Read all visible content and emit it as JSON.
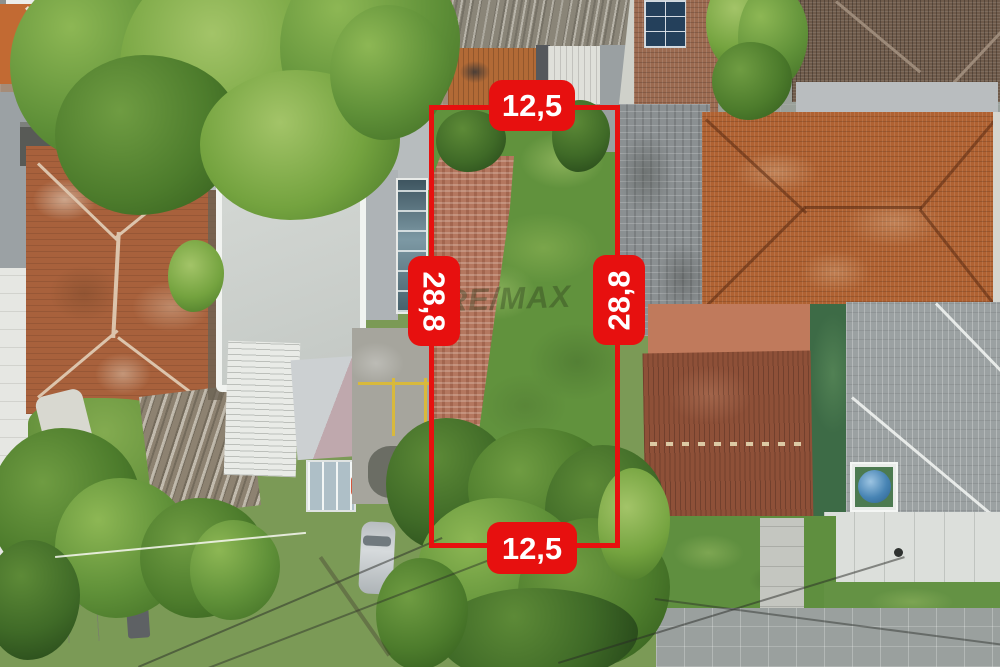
{
  "annotation": {
    "accent_color": "#e7100f",
    "lot": {
      "top_width_label": "12,5",
      "bottom_width_label": "12,5",
      "left_depth_label": "28,8",
      "right_depth_label": "28,8"
    },
    "watermark": "RE/MAX"
  }
}
